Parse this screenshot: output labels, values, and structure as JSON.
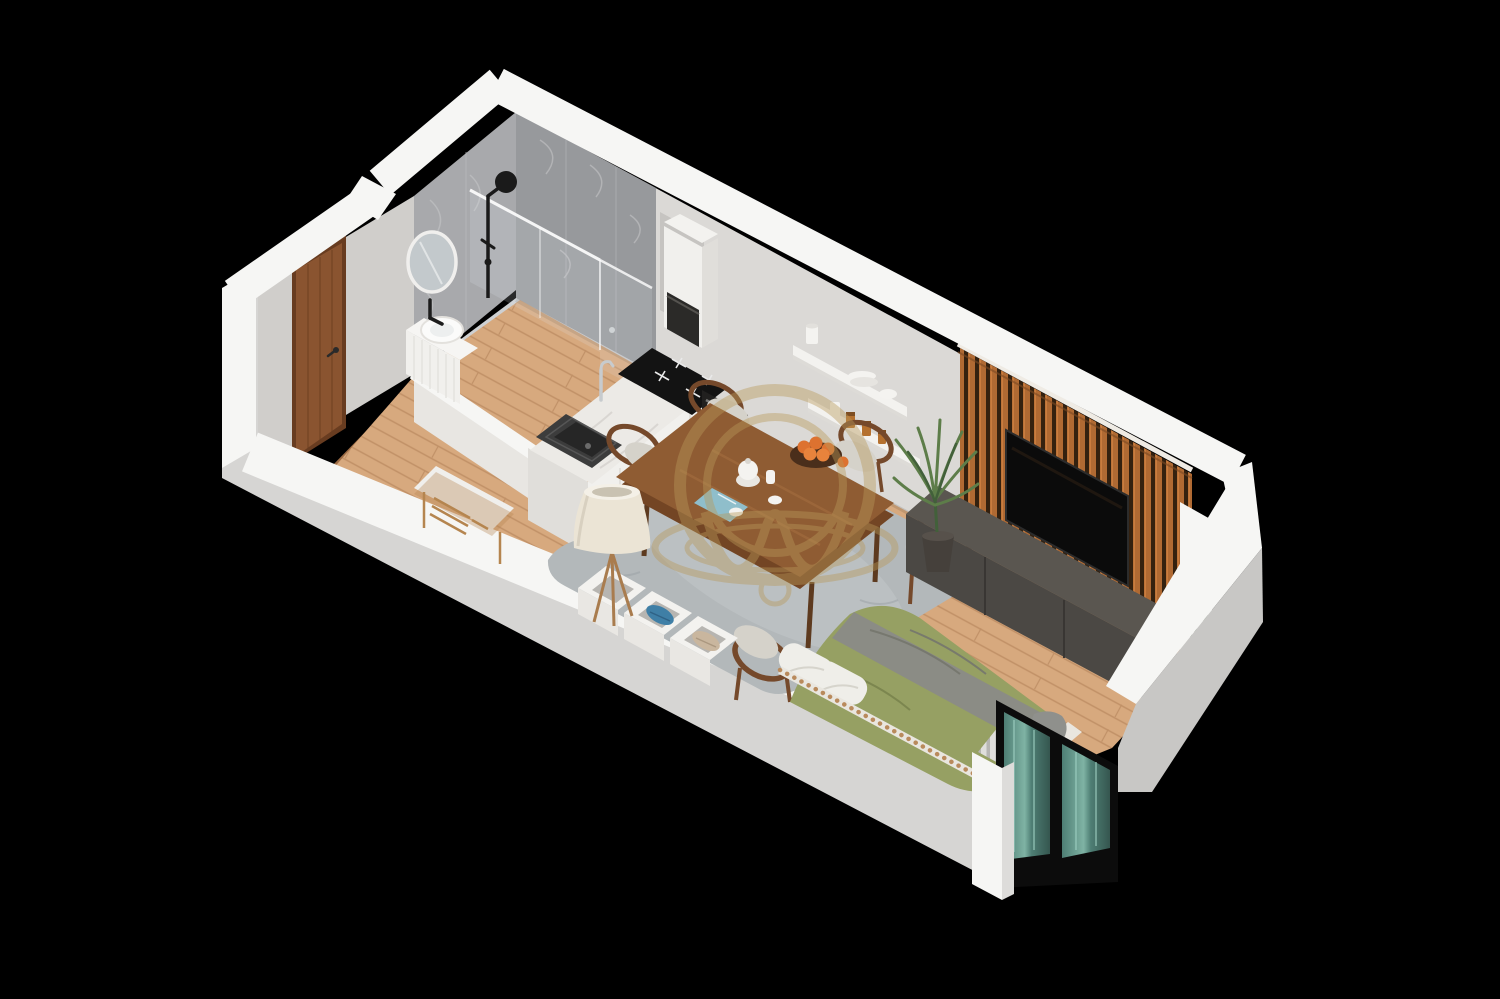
{
  "scene": {
    "title": "3D isometric floor plan render of a studio apartment on a black background",
    "type": "architectural-render",
    "background": "#000000"
  },
  "rooms": [
    {
      "name": "bathroom",
      "features": [
        "gray marble tile walls",
        "walk-in shower with glass screen",
        "black rain shower column",
        "round mirror",
        "white vanity with vessel basin",
        "linear floor drain"
      ]
    },
    {
      "name": "entry-hall",
      "features": [
        "wooden entrance door",
        "dark wood floor",
        "wood bench with white cushion and shoe shelf"
      ]
    },
    {
      "name": "kitchen",
      "features": [
        "white cabinets with marble worktop",
        "black composite sink with chrome tap",
        "black induction cooktop",
        "built-in black oven",
        "tall white unit with black appliance",
        "two white wall shelves with dishes and spice jars"
      ]
    },
    {
      "name": "living-dining",
      "features": [
        "walnut dining table with five wood chairs",
        "bowl of oranges and tea set",
        "gray shag rug",
        "wood slat TV accent wall",
        "wall-mounted TV",
        "dark media console",
        "tall palm plant",
        "floor lamp",
        "white storage cubbies with towels"
      ]
    },
    {
      "name": "sleeping-area",
      "features": [
        "bed with olive green duvet, gray throw and white pillows",
        "bead-trimmed side rail",
        "white radiator",
        "floor-to-ceiling window with teal glass"
      ]
    }
  ],
  "watermark": {
    "shape": "gold double-ring monogram with M swoosh",
    "color": "#b8995a",
    "opacity": 0.42
  },
  "palette": {
    "bg": "#000000",
    "wallTop": "#f6f6f4",
    "wallExtSW": "#d6d5d3",
    "wallExtSE": "#c8c7c5",
    "wallIntNE": "#dbd9d6",
    "wallIntNW": "#d0cecb",
    "tileA": "#a8a9ac",
    "tileB": "#97999c",
    "tileStreak": "#bdbec1",
    "bathFloor": "#ced0d2",
    "bathFloorLight": "#dadcde",
    "floorWood": "#d7a97e",
    "floorSeam": "#c19167",
    "entryWood": "#9c6b44",
    "entrySeam": "#7d5434",
    "door": "#8a5430",
    "doorDark": "#683c20",
    "counterTop": "#eceae6",
    "marbleStreak": "#d7d4cf",
    "cabinet": "#f1f0ed",
    "cabinetShade": "#e0deda",
    "sink": "#3c3c3c",
    "sinkDark": "#262626",
    "chrome": "#c7cbce",
    "cooktop": "#131313",
    "cooktopMark": "#e9e9e9",
    "oven": "#21201f",
    "ovenGlass": "#382f26",
    "shelfWhite": "#f3f2ef",
    "jarAmber": "#b5712f",
    "jarCap": "#7e4e22",
    "appliance": "#2b2a28",
    "slat": "#b06a33",
    "slatGap": "#34210f",
    "slatTrim": "#efebe4",
    "tv": "#0b0b0b",
    "console": "#4b4844",
    "consoleTop": "#5a5650",
    "consoleDark": "#3e3b38",
    "rug": "#b3b8ba",
    "rugLight": "#c6cacb",
    "table": "#8f5c33",
    "tableEdge": "#734524",
    "tableLeg": "#5d3a1f",
    "chairWood": "#75492b",
    "chairSeat": "#d5d2ca",
    "orange": "#dd7230",
    "bowl": "#4a2e1b",
    "clothBlue": "#8fc3d4",
    "porcelain": "#f4f3f0",
    "bedOlive": "#96a063",
    "bedOliveDark": "#75804a",
    "bedGray": "#8b8c85",
    "pillow": "#efeee9",
    "bedFrame": "#e9e6df",
    "bead": "#b98a5c",
    "radiator": "#dfdedc",
    "radiatorGap": "#b6b5b3",
    "radiatorCloth": "#8f908c",
    "windowFrame": "#0c0c0c",
    "glassTeal": "#4e7e74",
    "glassTealLight": "#7fb3a4",
    "plant": "#5d7d49",
    "plantDark": "#42603a",
    "pot": "#45403b",
    "lampShade": "#ebe4d5",
    "lampWood": "#a97c4e",
    "bench": "#b5854f",
    "benchCushion": "#f0efec",
    "towelBlue": "#3f7fa6",
    "blanketBeige": "#c9b69e",
    "boxInner": "#b7b5b1",
    "gold": "#b8995a",
    "mirror": "#c3c9cc",
    "niche": "#c6c4c1"
  }
}
